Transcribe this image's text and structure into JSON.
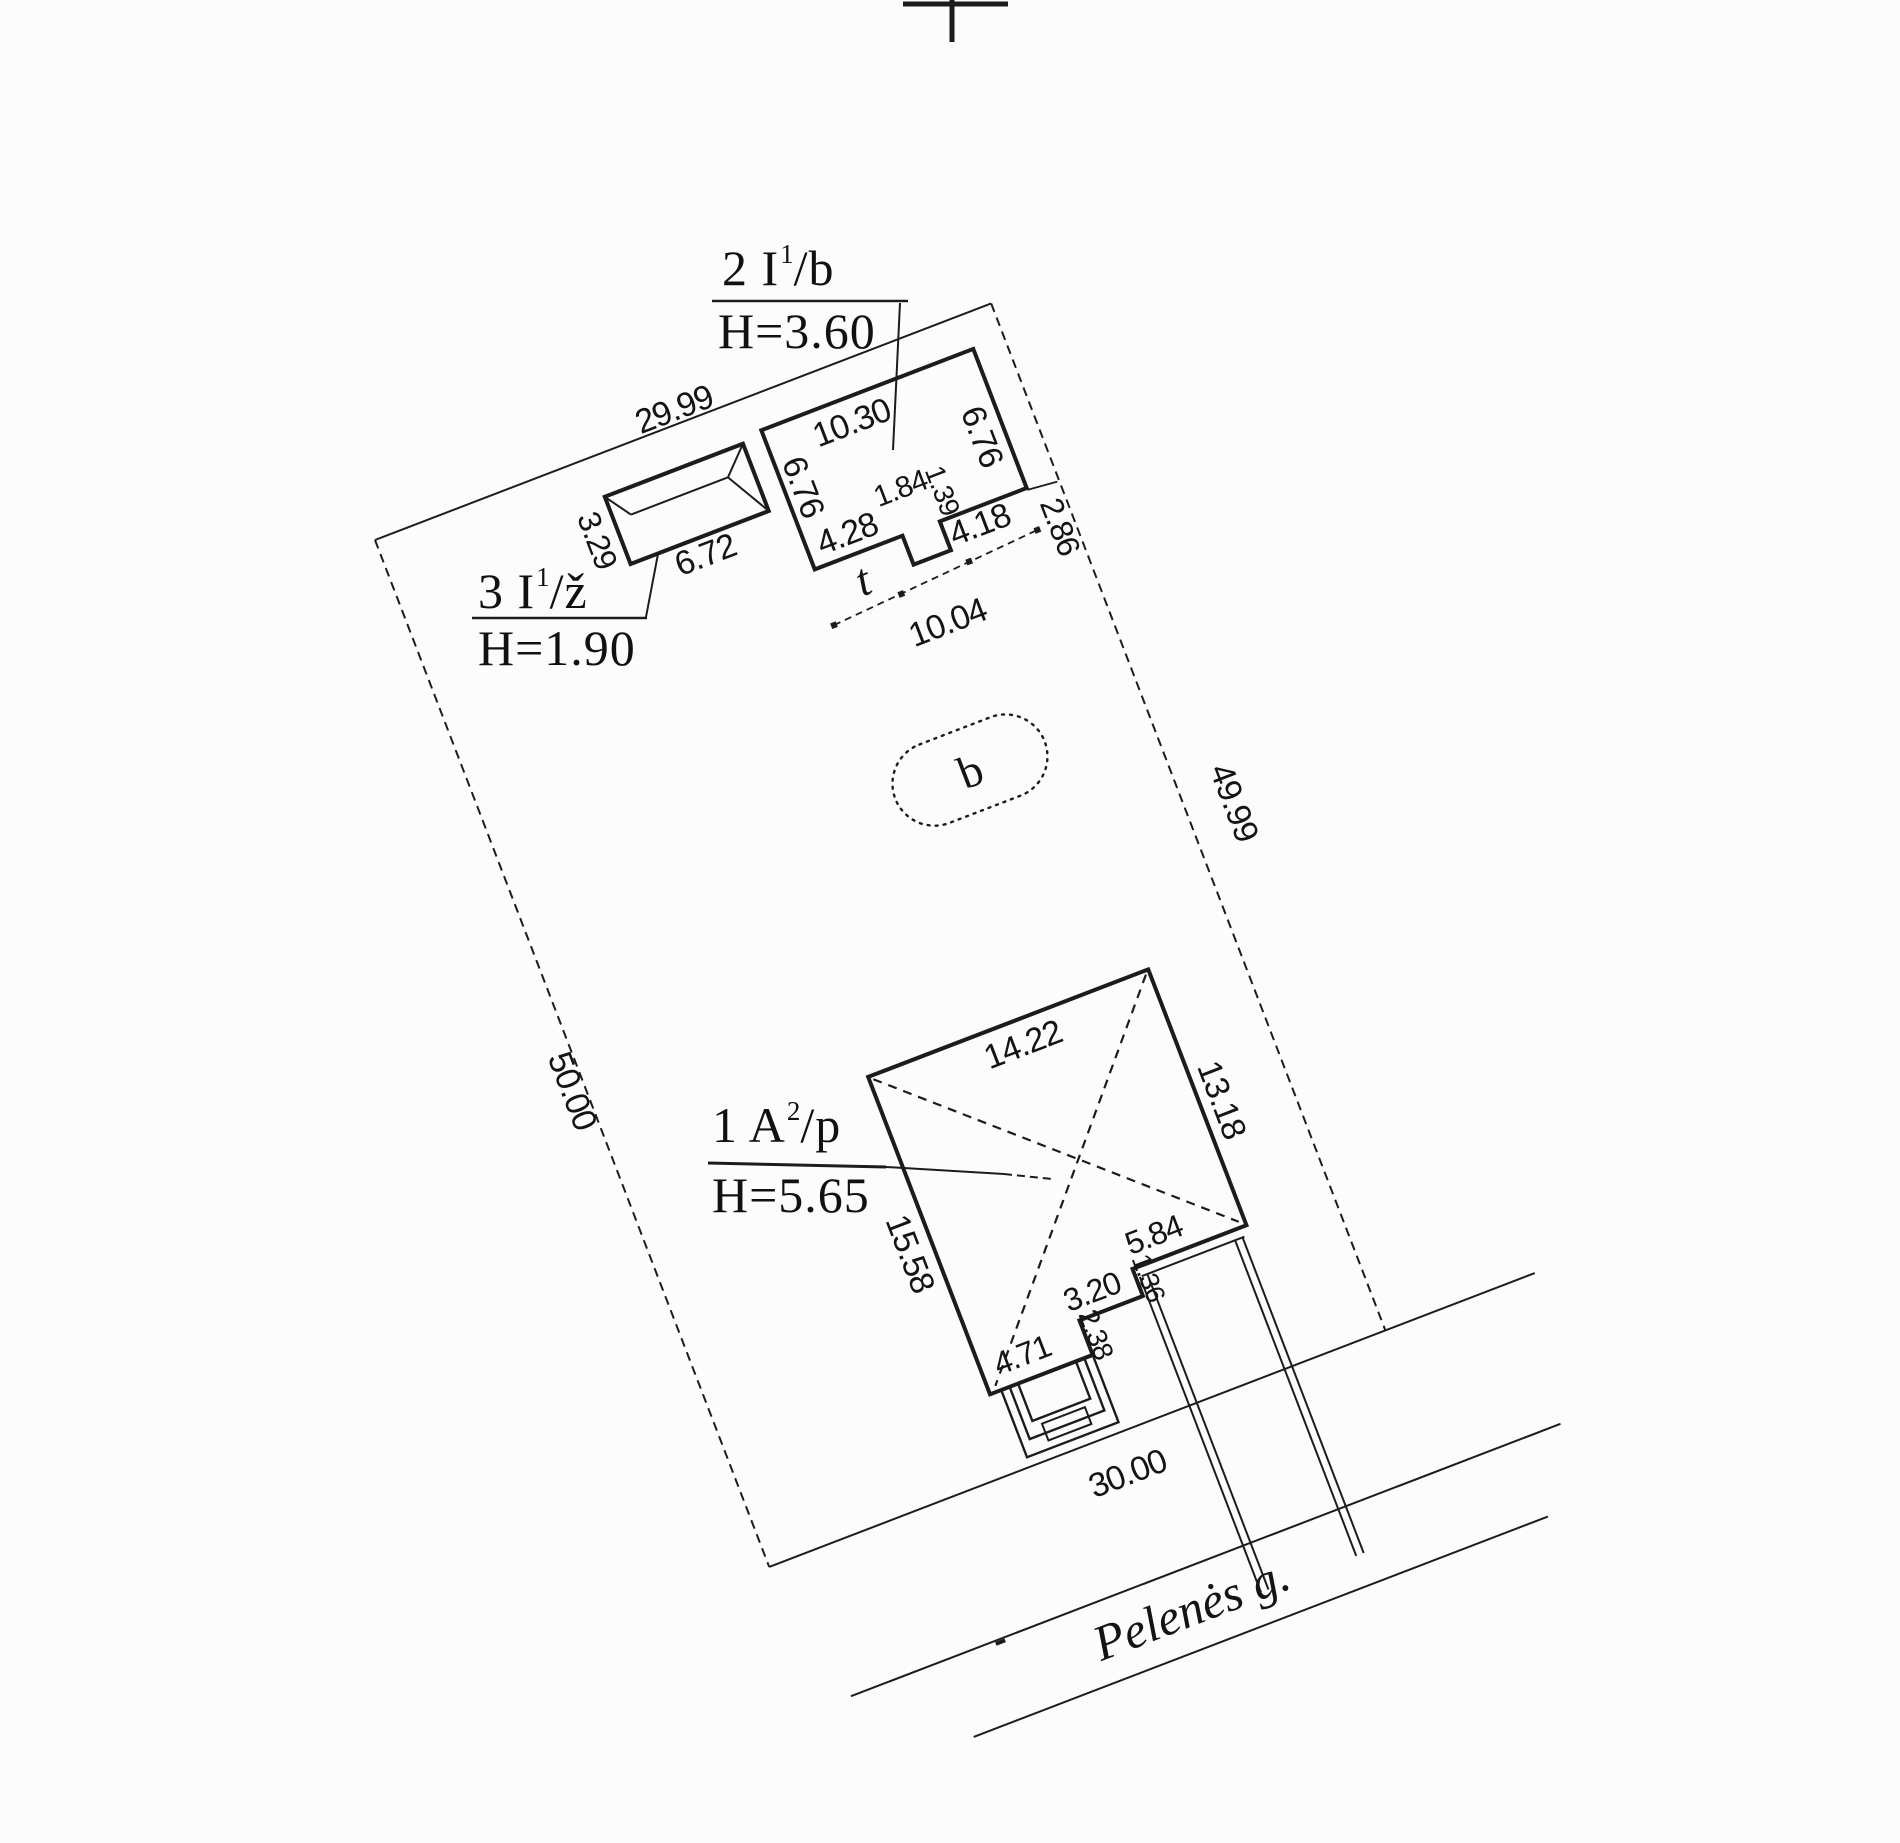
{
  "drawing": {
    "kind": "cadastral site plan",
    "street": {
      "name": "Pelenės g."
    },
    "plot_dimensions": {
      "top": "29.99",
      "right": "49.99",
      "left": "50.00",
      "bottom": "30.00"
    },
    "markers": {
      "area_marker": "b",
      "terrain_marker": "t"
    },
    "line_color": "#1c1c1c"
  },
  "buildings": [
    {
      "label_prefix": "1 A",
      "label_sup": "2",
      "label_suffix": "/p",
      "height_label": "H=5.65",
      "dimensions": [
        "14.22",
        "13.18",
        "15.58",
        "5.84",
        "3.20",
        "1.36",
        "2.38",
        "4.71"
      ]
    },
    {
      "label_prefix": "2 I",
      "label_sup": "1",
      "label_suffix": "/b",
      "height_label": "H=3.60",
      "dimensions": [
        "10.30",
        "6.76",
        "6.76",
        "4.28",
        "1.84",
        "1.39",
        "4.18",
        "2.86",
        "10.04"
      ]
    },
    {
      "label_prefix": "3 I",
      "label_sup": "1",
      "label_suffix": "/ž",
      "height_label": "H=1.90",
      "dimensions": [
        "3.29",
        "6.72"
      ]
    }
  ],
  "dim_labels": [
    {
      "text": "29.99",
      "x": 326,
      "y": -14,
      "rot": 0
    },
    {
      "text": "49.99",
      "x": 707,
      "y": 553,
      "rot": 90
    },
    {
      "text": "50.00",
      "x": -14,
      "y": 585,
      "rot": 90
    },
    {
      "text": "30.00",
      "x": 368,
      "y": 1142,
      "rot": 0
    },
    {
      "text": "10.30",
      "x": 487,
      "y": 62,
      "rot": 0
    },
    {
      "text": "6.76",
      "x": 418,
      "y": 104,
      "rot": 90
    },
    {
      "text": "6.76",
      "x": 603,
      "y": 121,
      "rot": 90
    },
    {
      "text": "4.28",
      "x": 443,
      "y": 164,
      "rot": 0
    },
    {
      "text": "1.84",
      "x": 509,
      "y": 141,
      "rot": 0,
      "size": 30
    },
    {
      "text": "1.39",
      "x": 547,
      "y": 157,
      "rot": 90,
      "size": 28
    },
    {
      "text": "4.18",
      "x": 570,
      "y": 203,
      "rot": 0
    },
    {
      "text": "2.86",
      "x": 644,
      "y": 233,
      "rot": 90,
      "size": 32
    },
    {
      "text": "10.04",
      "x": 505,
      "y": 283,
      "rot": 0
    },
    {
      "text": "t",
      "x": 441,
      "y": 212,
      "rot": 0,
      "cls": "serif-italic",
      "size": 46
    },
    {
      "text": "3.29",
      "x": 207,
      "y": 80,
      "rot": 90,
      "size": 32
    },
    {
      "text": "6.72",
      "x": 303,
      "y": 133,
      "rot": 0
    },
    {
      "text": "14.22",
      "x": 424,
      "y": 704,
      "rot": 0
    },
    {
      "text": "13.18",
      "x": 589,
      "y": 826,
      "rot": 90
    },
    {
      "text": "15.58",
      "x": 243,
      "y": 858,
      "rot": 90
    },
    {
      "text": "5.84",
      "x": 478,
      "y": 928,
      "rot": 0,
      "size": 32
    },
    {
      "text": "3.20",
      "x": 400,
      "y": 959,
      "rot": 0,
      "size": 32
    },
    {
      "text": "1.36",
      "x": 457,
      "y": 966,
      "rot": 90,
      "size": 27
    },
    {
      "text": "2.38",
      "x": 388,
      "y": 1000,
      "rot": 90,
      "size": 28
    },
    {
      "text": "4.71",
      "x": 312,
      "y": 993,
      "rot": 0,
      "size": 32
    },
    {
      "text": "b",
      "x": 473,
      "y": 429,
      "rot": 0,
      "cls": "serif",
      "size": 46
    },
    {
      "text": "Pelenės g.",
      "x": 379,
      "y": 1290,
      "rot": 0,
      "cls": "serif-italic",
      "size": 50
    }
  ]
}
